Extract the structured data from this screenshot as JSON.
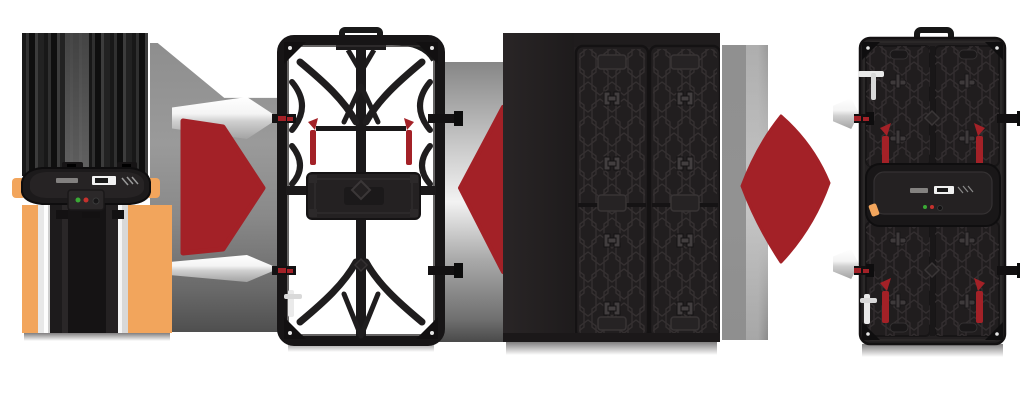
{
  "page": {
    "title": "LED panel assembly process illustration"
  },
  "colors": {
    "white": "#ffffff",
    "red": "#a32127",
    "orange": "#f2a55c",
    "panel_dark": "#232021",
    "panel_line": "#3a3637",
    "frame_dark": "#1b191a",
    "silver": "#e9e9e9",
    "gray_streak": "#8e8e8e",
    "led_green": "#3aaa35",
    "led_red": "#c5312d"
  },
  "items": [
    {
      "name": "controller-power-box",
      "role": "step-1-item"
    },
    {
      "name": "step-arrow-1",
      "role": "transition-arrow"
    },
    {
      "name": "panel-frame-back",
      "role": "step-2-item"
    },
    {
      "name": "step-arrow-2",
      "role": "transition-arrow"
    },
    {
      "name": "led-module-pair",
      "role": "step-3-item"
    },
    {
      "name": "step-arrow-3",
      "role": "transition-arrow"
    },
    {
      "name": "assembled-panel-back",
      "role": "step-4-item"
    }
  ],
  "indicators": [
    {
      "name": "insert-wedge-upper-left-of-frame"
    },
    {
      "name": "insert-wedge-lower-left-of-frame"
    },
    {
      "name": "insert-wedge-upper-left-of-cabinet"
    },
    {
      "name": "insert-wedge-lower-left-of-cabinet"
    }
  ],
  "led_indicators": [
    {
      "name": "status-led-green",
      "color": "#3aaa35"
    },
    {
      "name": "status-led-red",
      "color": "#c5312d"
    }
  ]
}
